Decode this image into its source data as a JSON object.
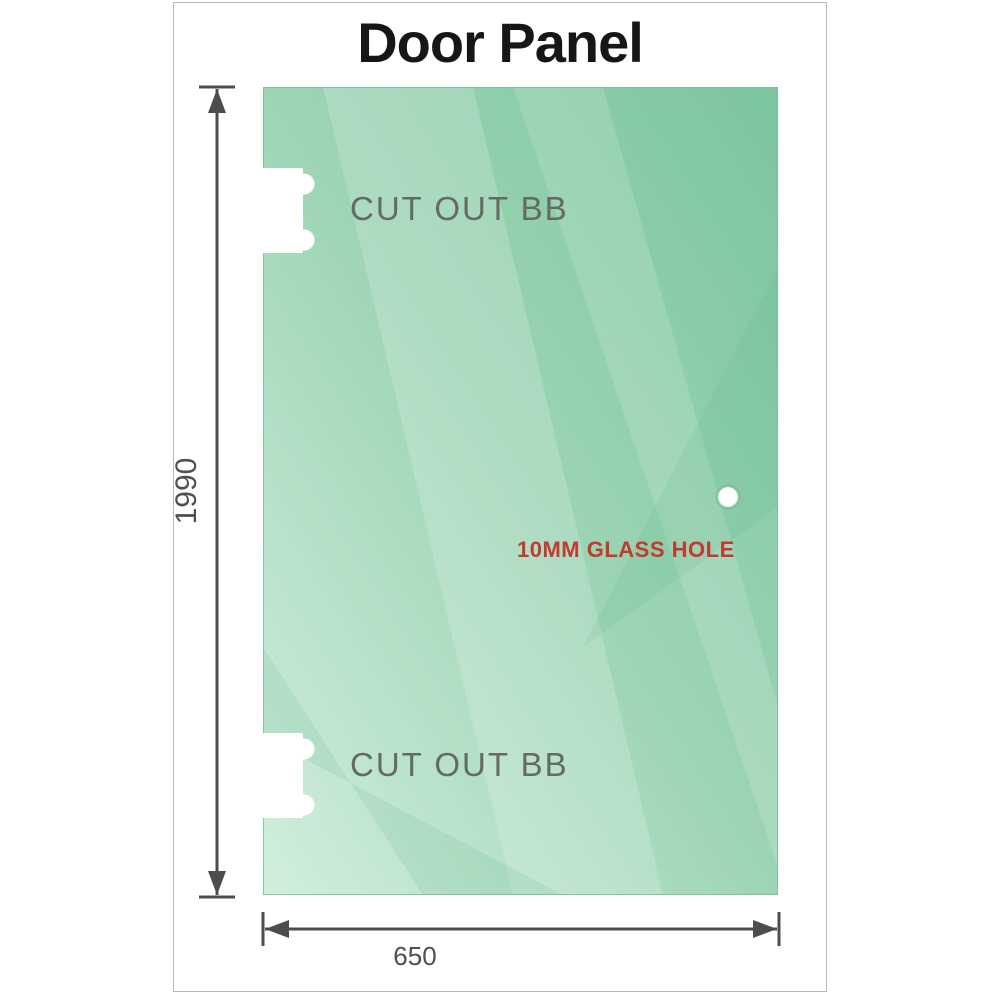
{
  "title": "Door Panel",
  "panel": {
    "cutout_top_label": "CUT OUT BB",
    "cutout_bottom_label": "CUT OUT BB",
    "hole_label": "10MM GLASS HOLE"
  },
  "dimensions": {
    "height_mm": "1990",
    "width_mm": "650"
  },
  "colors": {
    "glass_dark": "#7cc59e",
    "glass_mid": "#9dd5b5",
    "glass_light": "#d2eedd",
    "glass_edge": "#79bd99",
    "dimension_line": "#4d4d4d",
    "cutout_label_gray": "#646b64",
    "hole_label_red": "#c23b2e",
    "frame_border": "#b9b9b9",
    "title_color": "#161616"
  }
}
